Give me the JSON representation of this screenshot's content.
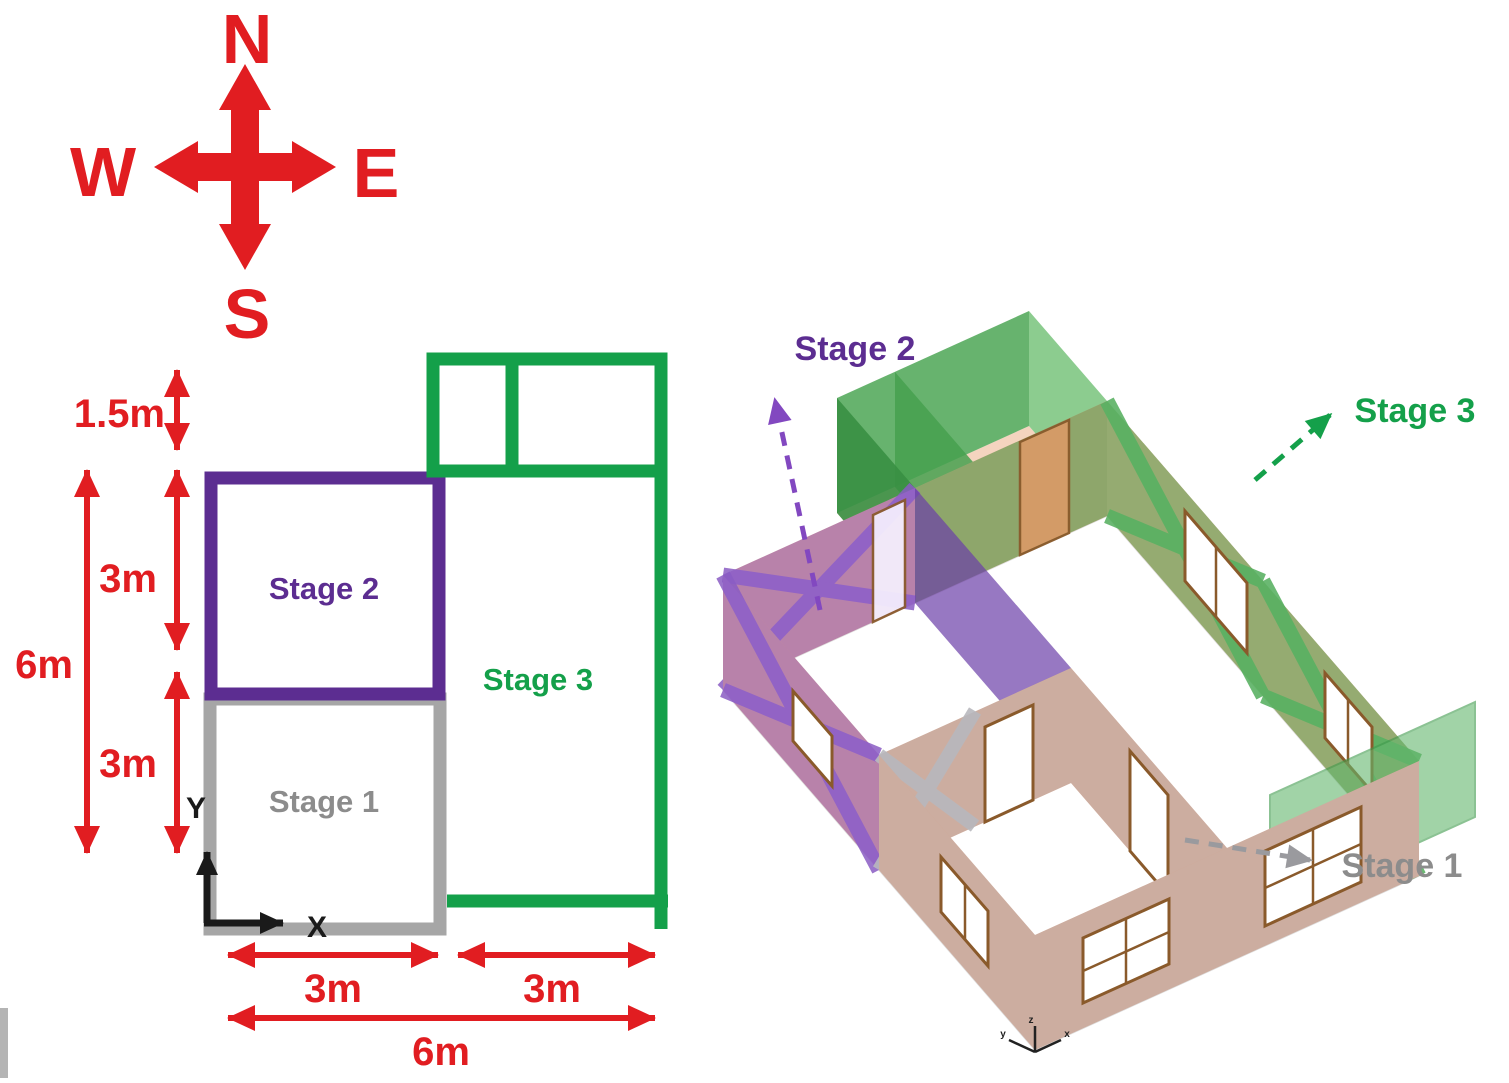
{
  "compass": {
    "north": "N",
    "south": "S",
    "east": "E",
    "west": "W"
  },
  "plan": {
    "stage1_label": "Stage 1",
    "stage2_label": "Stage 2",
    "stage3_label": "Stage 3",
    "axis_x": "X",
    "axis_y": "Y",
    "dims": {
      "left_top": "1.5m",
      "left_mid": "3m",
      "left_bottom": "3m",
      "left_total": "6m",
      "bottom_left": "3m",
      "bottom_right": "3m",
      "bottom_total": "6m"
    }
  },
  "model3d": {
    "stage1_label": "Stage 1",
    "stage2_label": "Stage 2",
    "stage3_label": "Stage 3",
    "axis_x": "x",
    "axis_y": "y",
    "axis_z": "z"
  },
  "colors": {
    "red": "#e11d21",
    "purple": "#5c2d91",
    "green": "#14a04a",
    "gray": "#a6a6a6",
    "gray_text": "#8c8c8c",
    "black": "#1a1a1a",
    "purple_3d": "#8d5fd0",
    "purple_3d_dark": "#6b3fa8",
    "green_3d": "#55b061",
    "green_3d_dark": "#388f43",
    "gray_3d": "#b6b6bb",
    "tan_sheathing": "#e3a585",
    "frame_brown": "#8a5a2b",
    "floor_white": "#ffffff"
  }
}
